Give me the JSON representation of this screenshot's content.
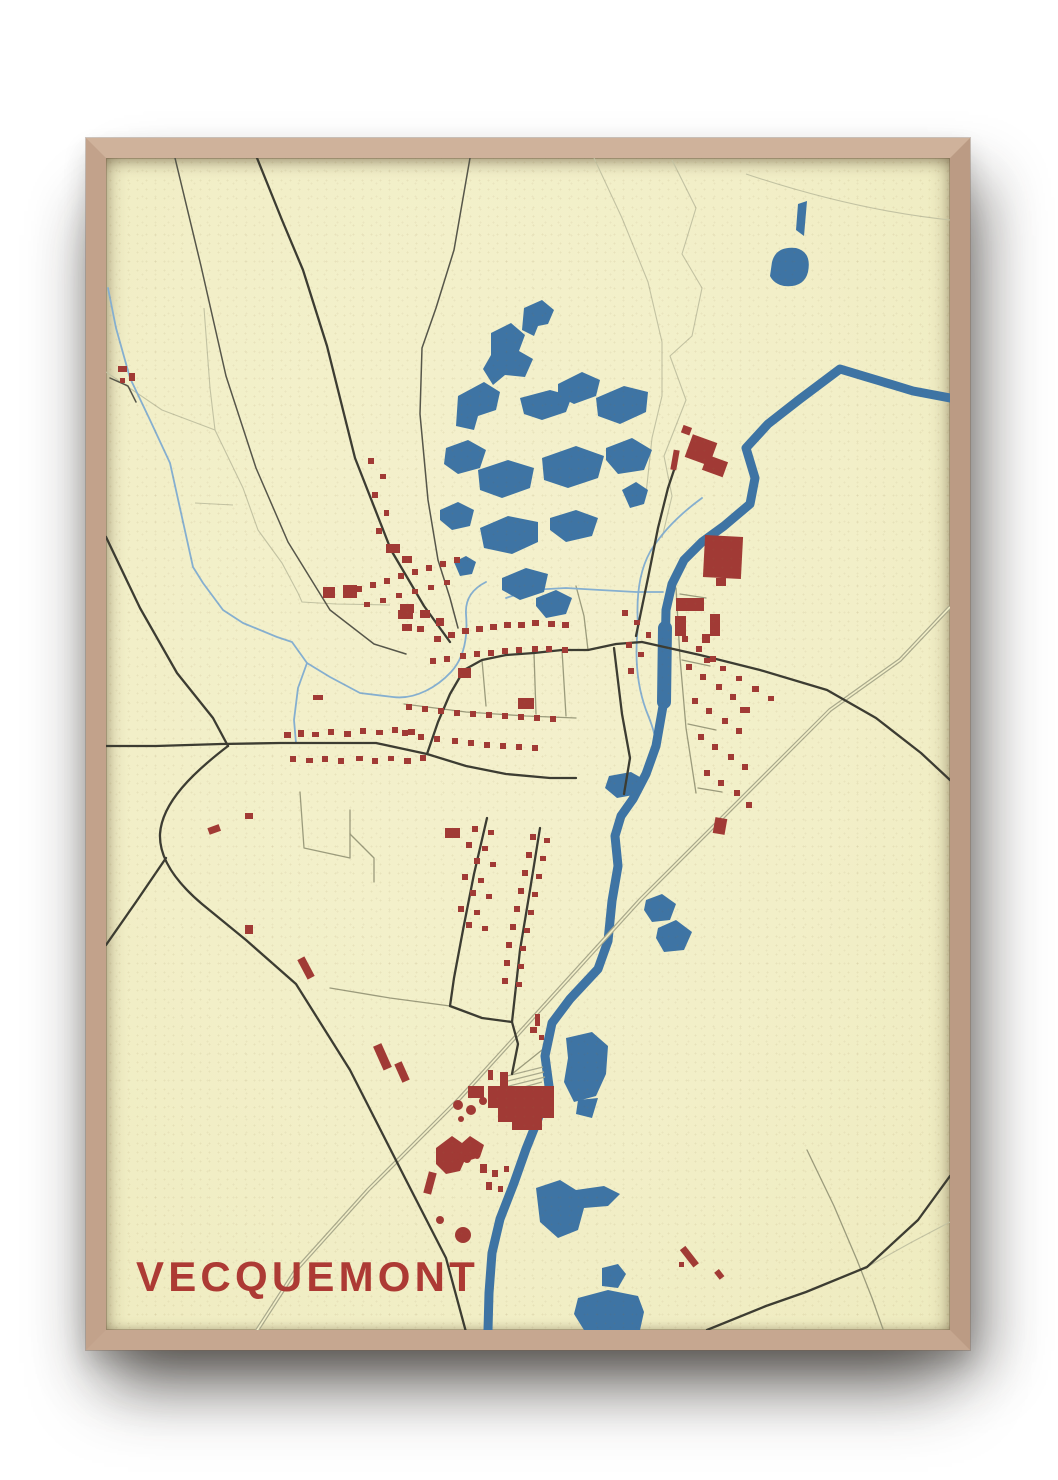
{
  "poster": {
    "title": "VECQUEMONT"
  },
  "map": {
    "place_name": "VECQUEMONT",
    "style": "vintage-street-map-poster",
    "features": [
      "river",
      "lakes",
      "ponds",
      "streams",
      "major-roads",
      "minor-roads",
      "railway",
      "buildings",
      "factory",
      "field-boundaries"
    ]
  },
  "theme": {
    "wall_color": "#ffffff",
    "frame_color": "#c5a58e",
    "paper_color": "#f2efc8",
    "water_color": "#3e74a4",
    "stream_color": "#85afd0",
    "building_color": "#a13a35",
    "title_color": "#ad3a34",
    "road_major_color": "#3c3c32",
    "road_medium_color": "#56564a",
    "road_minor_color": "#9b9b7c",
    "railway_color": "#a9a98c",
    "boundary_color": "#c2c2a2"
  }
}
